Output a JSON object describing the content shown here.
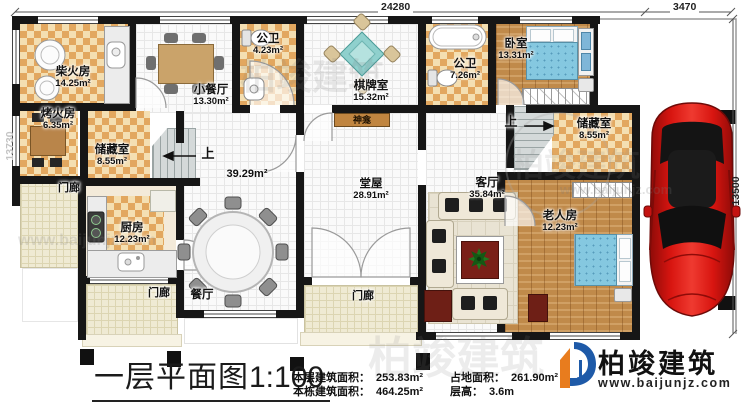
{
  "dimensions": {
    "top_main": "24280",
    "garage_width": "3470",
    "right_height": "13500",
    "left_height": "13730"
  },
  "rooms": {
    "chaihuofang": {
      "name": "柴火房",
      "area": "14.25m²"
    },
    "xiaocanting": {
      "name": "小餐厅",
      "area": "13.30m²"
    },
    "gongwei1": {
      "name": "公卫",
      "area": "4.23m²"
    },
    "qipaishi": {
      "name": "棋牌室",
      "area": "15.32m²"
    },
    "gongwei2": {
      "name": "公卫",
      "area": "7.26m²"
    },
    "woshi": {
      "name": "卧室",
      "area": "13.31m²"
    },
    "kaohuofang": {
      "name": "烤火房",
      "area": "6.35m²"
    },
    "chucangshi_left": {
      "name": "储藏室",
      "area": "8.55m²"
    },
    "chufang": {
      "name": "厨房",
      "area": "12.23m²"
    },
    "canting": {
      "name": "餐厅",
      "area": "39.29m²"
    },
    "tangwu": {
      "name": "堂屋",
      "area": "28.91m²"
    },
    "keting": {
      "name": "客厅",
      "area": "35.84m²"
    },
    "chucangshi_right": {
      "name": "储藏室",
      "area": "8.55m²"
    },
    "laorenfang": {
      "name": "老人房",
      "area": "12.23m²"
    }
  },
  "labels": {
    "porch": "门廊",
    "up": "上",
    "shrine": "神龛"
  },
  "title_block": {
    "title": "一层平面图",
    "scale": "1:100",
    "stats_left": [
      {
        "label": "本层建筑面积：",
        "value": "253.83m²"
      },
      {
        "label": "本栋建筑面积：",
        "value": "464.25m²"
      }
    ],
    "stats_right": [
      {
        "label": "占地面积：",
        "value": "261.90m²"
      },
      {
        "label": "层高：",
        "value": "3.6m"
      }
    ]
  },
  "logo": {
    "name": "柏竣建筑",
    "url": "www.baijunjz.com"
  },
  "watermark": {
    "brand": "柏竣建筑",
    "url": "www.baijunjz.com"
  }
}
